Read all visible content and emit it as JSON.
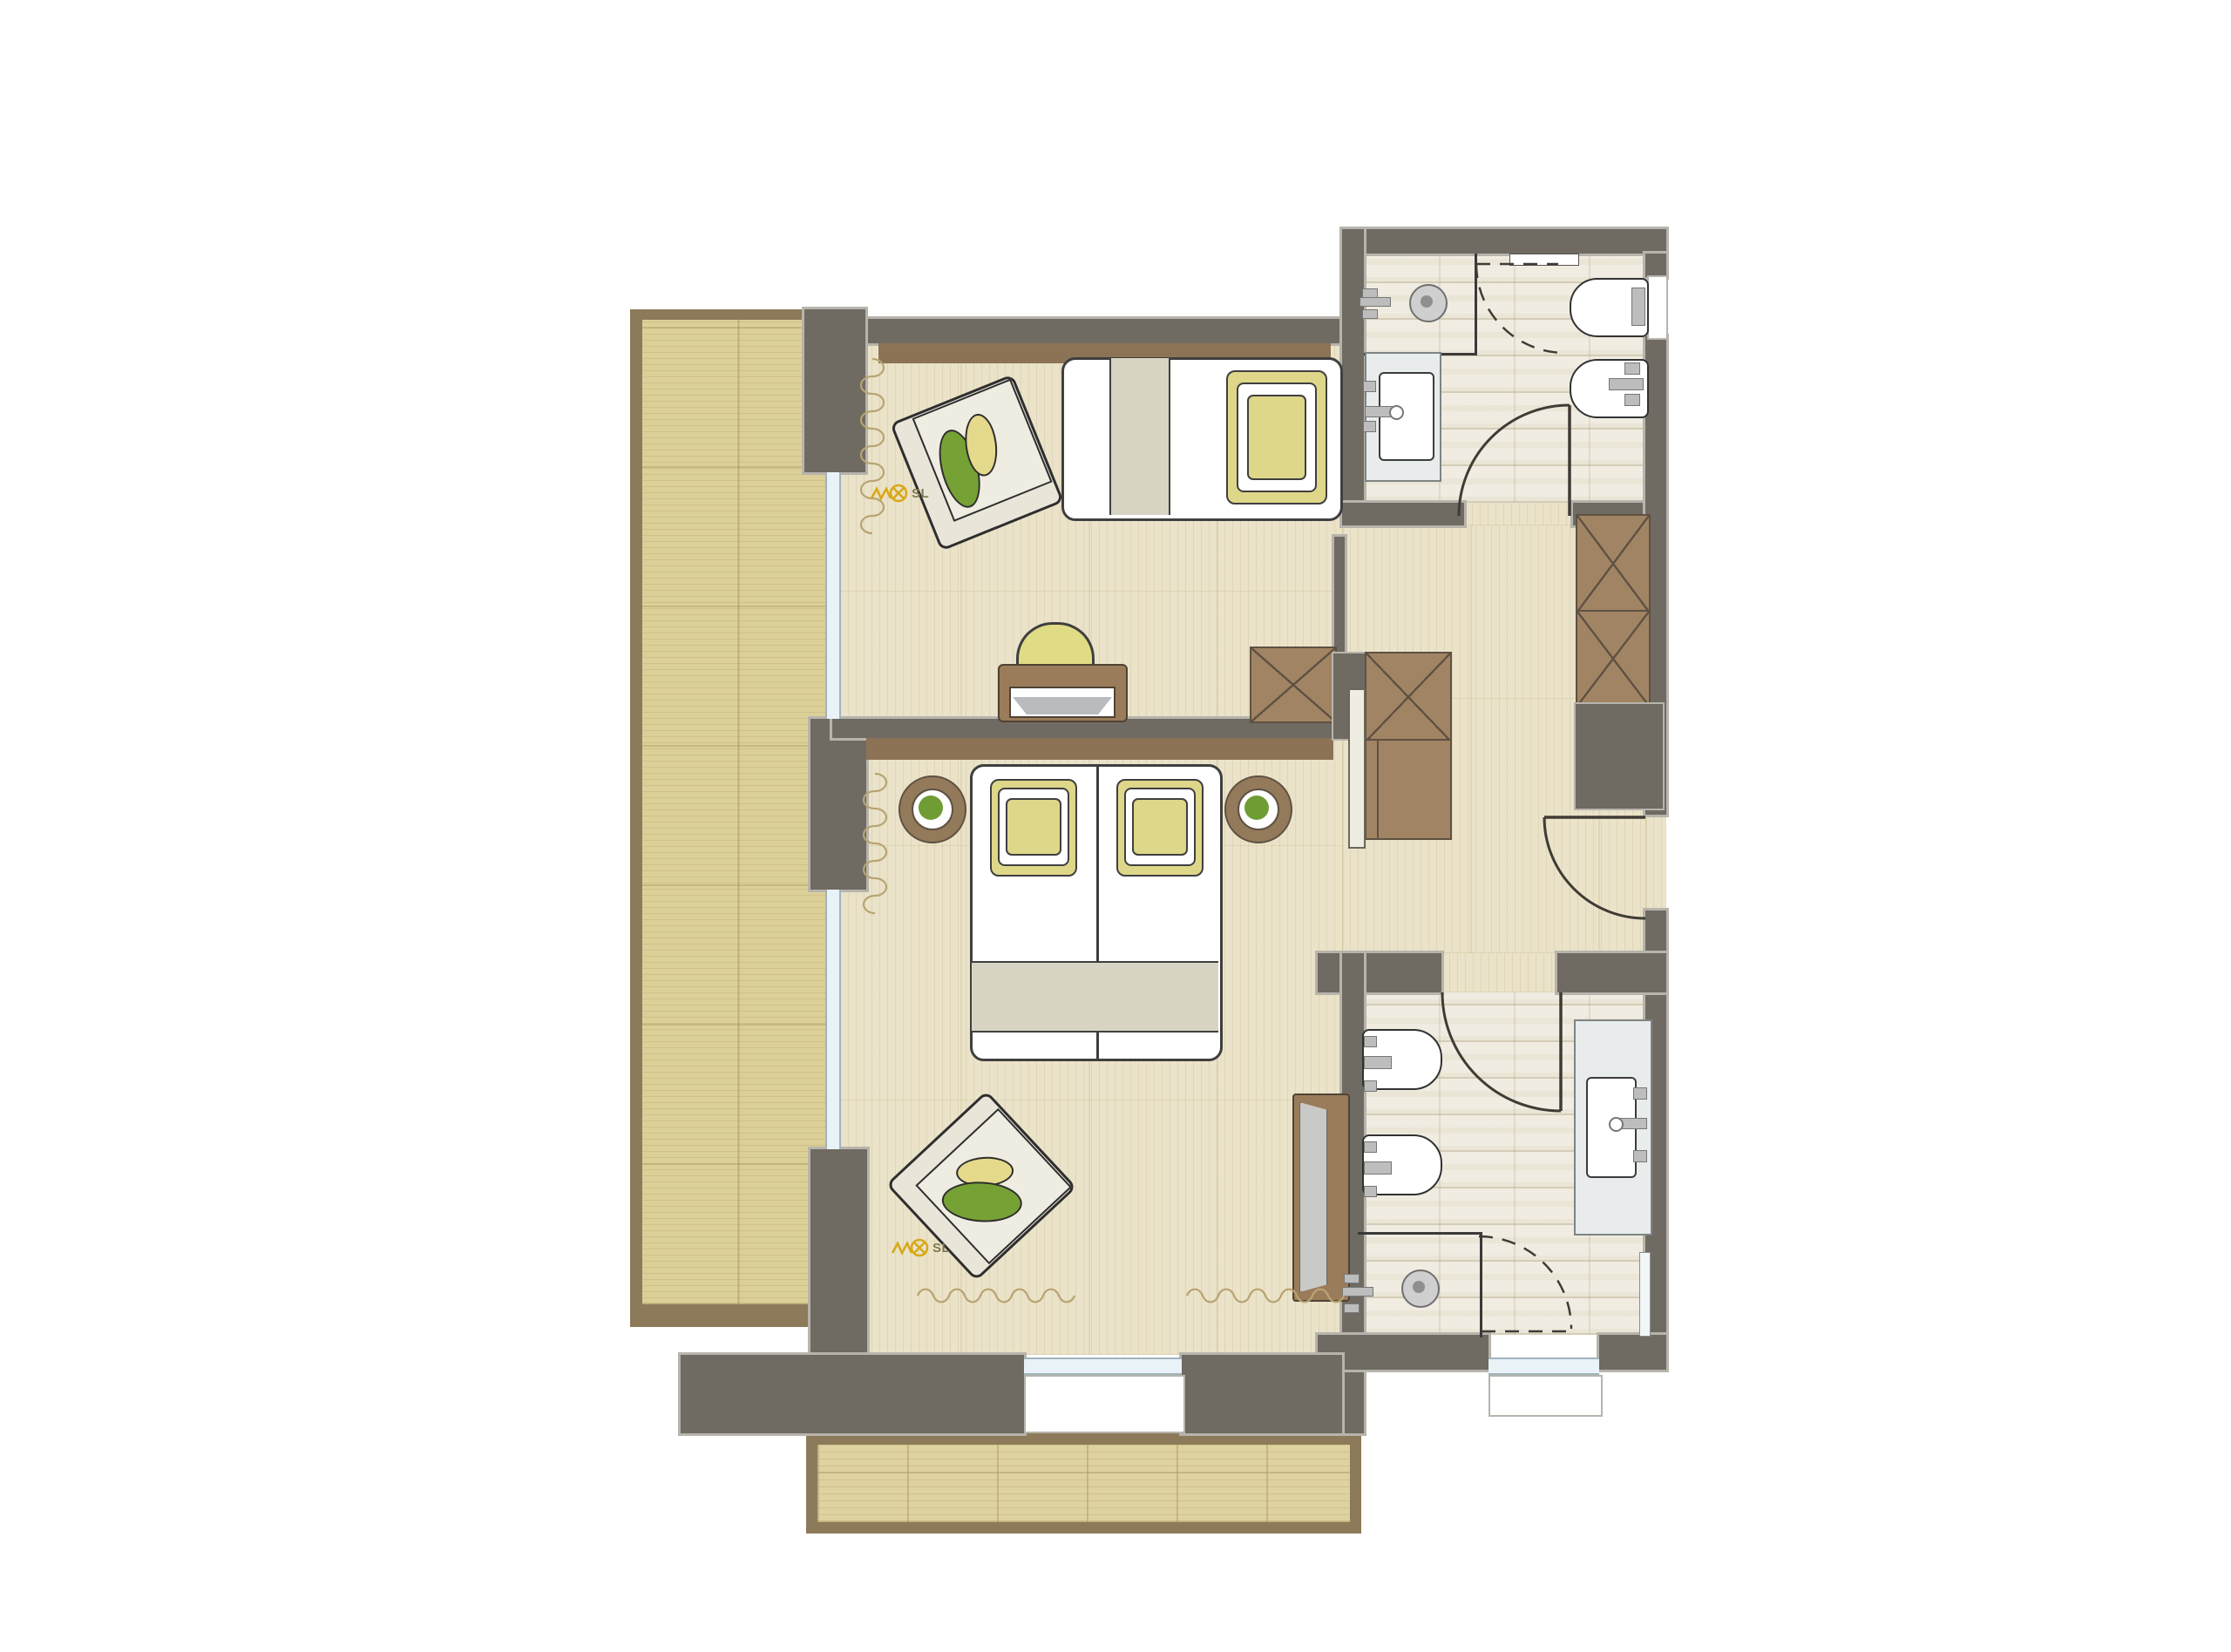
{
  "labels": {
    "sl_upper": {
      "text": "SL"
    },
    "sl_lower": {
      "text": "SL"
    }
  },
  "palette": {
    "wall_dark": "#6f6b62",
    "wall_outline": "#b7b4ac",
    "wood_trim_brown": "#8d7355",
    "balcony_border_brown": "#8d7a5a",
    "interior_floor": "#eae3c9",
    "deck_wood": "#dcd099",
    "bathroom_tile": "#f0ece1",
    "furniture_brown": "#a18464",
    "pillow_yellow": "#ded789",
    "cushion_green": "#76a135",
    "glass_blue": "#e9f2f6",
    "luminaire_yellow": "#d8a818"
  },
  "elements": {
    "rooms": [
      "upper-room-with-single-bed",
      "main-bedroom",
      "entry-hall",
      "bathroom-top",
      "bathroom-bottom",
      "balcony-left",
      "balcony-bottom"
    ],
    "furniture": [
      "single-bed",
      "double-bed",
      "armchair-upper",
      "armchair-lower",
      "desk",
      "desk-chair",
      "bedside-table-left",
      "bedside-table-right",
      "wardrobe-x-boxes",
      "sliding-door-panel",
      "sideboard"
    ],
    "fixtures": [
      "shower-top",
      "shower-bottom",
      "toilet-top",
      "bidet-top",
      "toilet-bottom",
      "bidet-bottom",
      "vanity-sink-top",
      "vanity-sink-bottom",
      "mirror-bottom"
    ],
    "symbols": [
      "luminaire-symbol-upper",
      "luminaire-symbol-lower",
      "door-swing-arcs",
      "curtain-squiggles"
    ]
  }
}
